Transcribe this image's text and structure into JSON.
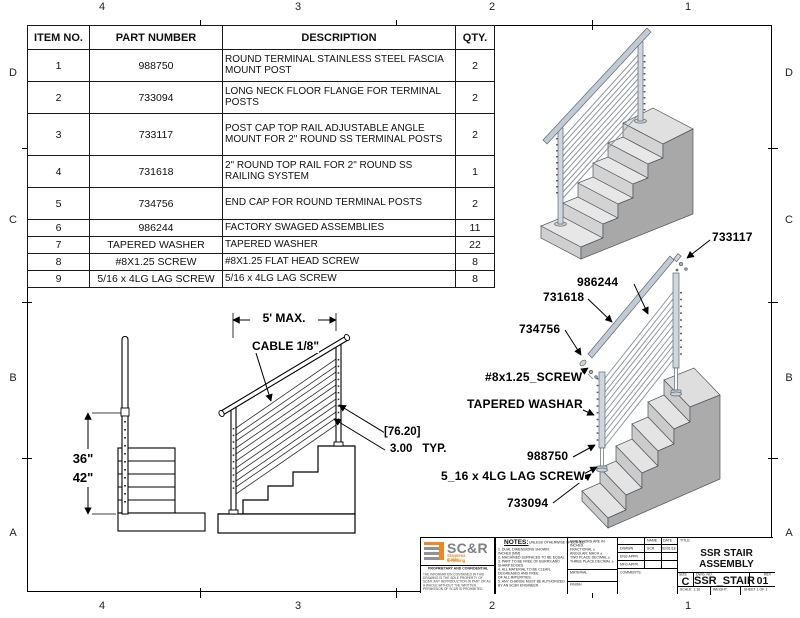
{
  "sheet": {
    "zones": {
      "columns": [
        "4",
        "3",
        "2",
        "1"
      ],
      "rows": [
        "D",
        "C",
        "B",
        "A"
      ]
    }
  },
  "bom": {
    "headers": {
      "item": "ITEM NO.",
      "part": "PART NUMBER",
      "desc": "DESCRIPTION",
      "qty": "QTY."
    },
    "rows": [
      {
        "item": "1",
        "part": "988750",
        "desc": "ROUND TERMINAL STAINLESS STEEL FASCIA MOUNT POST",
        "qty": "2"
      },
      {
        "item": "2",
        "part": "733094",
        "desc": "LONG NECK FLOOR FLANGE FOR TERMINAL POSTS",
        "qty": "2"
      },
      {
        "item": "3",
        "part": "733117",
        "desc": "POST CAP TOP RAIL ADJUSTABLE ANGLE MOUNT FOR 2\" ROUND SS TERMINAL POSTS",
        "qty": "2"
      },
      {
        "item": "4",
        "part": "731618",
        "desc": "2\" ROUND TOP RAIL FOR 2\" ROUND SS RAILING SYSTEM",
        "qty": "1"
      },
      {
        "item": "5",
        "part": "734756",
        "desc": "END CAP FOR ROUND TERMINAL POSTS",
        "qty": "2"
      },
      {
        "item": "6",
        "part": "986244",
        "desc": "FACTORY SWAGED ASSEMBLIES",
        "qty": "11"
      },
      {
        "item": "7",
        "part": "TAPERED WASHER",
        "desc": "TAPERED WASHER",
        "qty": "22"
      },
      {
        "item": "8",
        "part": "#8X1.25 SCREW",
        "desc": "#8X1.25 FLAT HEAD SCREW",
        "qty": "8"
      },
      {
        "item": "9",
        "part": "5/16 x 4LG LAG SCREW",
        "desc": "5/16 x 4LG LAG SCREW",
        "qty": "8"
      }
    ]
  },
  "dimensions": {
    "span": "5' MAX.",
    "cable": "CABLE 1/8\"",
    "height_a": "36\"",
    "height_b": "42\"",
    "spacing_mm": "[76.20]",
    "spacing_in": "3.00",
    "spacing_typ": "TYP."
  },
  "callouts": {
    "post_cap": "733117",
    "cables": "986244",
    "top_rail": "731618",
    "end_cap": "734756",
    "screw": "#8x1.25_SCREW",
    "washer": "TAPERED WASHAR",
    "post": "988750",
    "lag_screw": "5_16 x 4LG LAG SCREW",
    "flange": "733094"
  },
  "title_block": {
    "logo": {
      "brand": "SC&R",
      "brand_sub1": "Stainless Cable",
      "brand_sub2": "& Railing",
      "proprietary_title": "PROPRIETARY AND CONFIDENTIAL",
      "proprietary_body": "THE INFORMATION CONTAINED IN THIS DRAWING IS THE SOLE PROPERTY OF SC&R. ANY REPRODUCTION IN PART OR AS A WHOLE WITHOUT THE WRITTEN PERMISSION OF SC&R IS PROHIBITED."
    },
    "notes": {
      "label": "NOTES:",
      "qualifier": "UNLESS OTHERWISE SPECIFIED",
      "body": "1. DUAL DIMENSIONS SHOWN:\n    INCHES [MM]\n2. MACHINED SURFACES TO BE EQUAL\n3. PART TO BE FREE OF BURRS AND\n    SHARP EDGES.\n4. ALL MATERIAL TO BE CLEAN,\n    DEGREASED AND FREE\n    OF ALL IMPURITIES.\n5. ANY CHANGE MUST BE AUTHORIZED\n    BY AN SC&R ENGINEER."
    },
    "tolerances": {
      "body": "DIMENSIONS ARE IN INCHES\nFRACTIONAL ±\nANGULAR: MACH ±\nTWO PLACE DECIMAL ±\nTHREE PLACE DECIMAL ±",
      "material_label": "MATERIAL",
      "finish_label": "FINISH"
    },
    "approvals": {
      "name_header": "NAME",
      "date_header": "DATE",
      "drawn_label": "DRAWN",
      "drawn_name": "SCR",
      "drawn_date": "02/01/18",
      "eng_label": "ENG APPR.",
      "mfg_label": "MFG APPR.",
      "comments_label": "COMMENTS:"
    },
    "title_label": "TITLE:",
    "title": "SSR STAIR ASSEMBLY",
    "size_label": "SIZE",
    "size": "C",
    "dwg_label": "DWG. NO.",
    "dwg_no": "SSR_STAIR",
    "rev_label": "REV",
    "rev": "01",
    "scale": "SCALE: 1:16",
    "weight": "WEIGHT:",
    "sheet": "SHEET 1 OF 1"
  }
}
